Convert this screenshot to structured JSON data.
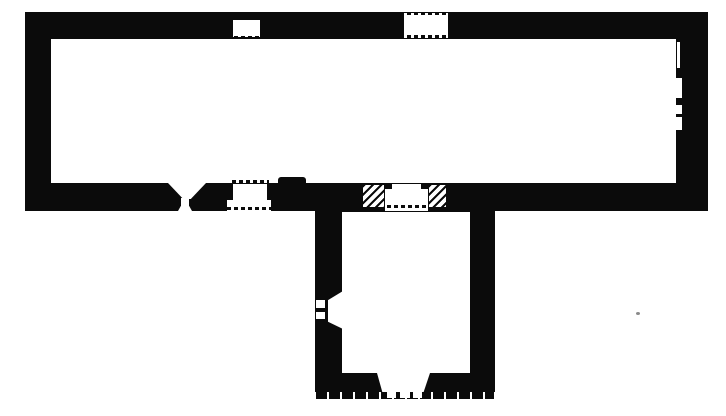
{
  "meta": {
    "kind": "scanned architectural floor plan, black ink on white paper",
    "building": "single long hall with square annex attached below centre-right"
  },
  "colors": {
    "ink": "#0b0b0b",
    "paper": "#ffffff",
    "speck": "#8a8a8a"
  },
  "canvas": {
    "width": 726,
    "height": 416
  },
  "icons": {
    "north_arrow": "upward arrow with crossbar (orientation mark)"
  },
  "elements": [
    {
      "name": "main-hall-walls",
      "type": "wall",
      "x": 25,
      "y": 12,
      "w": 683,
      "h": 199
    },
    {
      "name": "main-hall-floor",
      "type": "floor",
      "x": 51,
      "y": 39,
      "w": 625,
      "h": 144
    },
    {
      "name": "annex-walls",
      "type": "wall",
      "x": 315,
      "y": 211,
      "w": 180,
      "h": 181
    },
    {
      "name": "annex-ground-line",
      "type": "ground",
      "x": 316,
      "y": 392,
      "w": 178,
      "h": 7
    },
    {
      "name": "annex-floor",
      "type": "floor",
      "x": 342,
      "y": 212,
      "w": 128,
      "h": 161
    },
    {
      "name": "north-window-1-dots-outer",
      "type": "dots",
      "x": 233,
      "y": 12,
      "w": 28,
      "h": 3
    },
    {
      "name": "north-window-1-dots-mid",
      "type": "dots",
      "x": 236,
      "y": 16,
      "w": 22,
      "h": 3
    },
    {
      "name": "north-window-1-opening",
      "type": "floor",
      "x": 233,
      "y": 20,
      "w": 27,
      "h": 17
    },
    {
      "name": "north-window-1-dots-inner",
      "type": "dots",
      "x": 234,
      "y": 36,
      "w": 26,
      "h": 3
    },
    {
      "name": "north-window-2-opening",
      "type": "floor",
      "x": 404,
      "y": 13,
      "w": 44,
      "h": 25
    },
    {
      "name": "north-window-2-dots-outer",
      "type": "dots",
      "x": 400,
      "y": 12,
      "w": 52,
      "h": 3
    },
    {
      "name": "north-window-2-dots-inner",
      "type": "dots",
      "x": 400,
      "y": 35,
      "w": 52,
      "h": 3
    },
    {
      "name": "east-wall-niche-1",
      "type": "floor",
      "x": 677,
      "y": 42,
      "w": 3,
      "h": 26
    },
    {
      "name": "east-wall-niche-2",
      "type": "floor",
      "x": 676,
      "y": 78,
      "w": 6,
      "h": 20
    },
    {
      "name": "east-wall-niche-3",
      "type": "floor",
      "x": 676,
      "y": 105,
      "w": 6,
      "h": 9
    },
    {
      "name": "east-wall-niche-4",
      "type": "floor",
      "x": 676,
      "y": 117,
      "w": 6,
      "h": 13
    },
    {
      "name": "font-bowl",
      "type": "shape",
      "x": 168,
      "y": 183,
      "w": 38,
      "h": 16,
      "clip": "polygon(0 0, 100% 0, 60% 100%, 40% 100%)"
    },
    {
      "name": "font-stem",
      "type": "floor",
      "x": 181,
      "y": 198,
      "w": 8,
      "h": 9
    },
    {
      "name": "font-base",
      "type": "shape",
      "x": 178,
      "y": 206,
      "w": 14,
      "h": 5,
      "clip": "polygon(20% 0, 80% 0, 100% 100%, 0 100%)"
    },
    {
      "name": "south-door-dots-inner",
      "type": "dots",
      "x": 232,
      "y": 180,
      "w": 37,
      "h": 3
    },
    {
      "name": "south-door-reveal",
      "type": "floor",
      "x": 233,
      "y": 184,
      "w": 34,
      "h": 16
    },
    {
      "name": "south-door-step",
      "type": "floor",
      "x": 227,
      "y": 200,
      "w": 44,
      "h": 11
    },
    {
      "name": "south-door-dots-outer",
      "type": "dots",
      "x": 227,
      "y": 207,
      "w": 44,
      "h": 3
    },
    {
      "name": "south-wall-pier",
      "type": "wall",
      "x": 278,
      "y": 177,
      "w": 28,
      "h": 7,
      "radius": "3px 3px 0 0"
    },
    {
      "name": "arch-respond-hatch-west",
      "type": "hatch",
      "x": 362,
      "y": 184,
      "w": 23,
      "h": 24
    },
    {
      "name": "arch-respond-hatch-east",
      "type": "hatch",
      "x": 428,
      "y": 184,
      "w": 19,
      "h": 24
    },
    {
      "name": "arch-opening",
      "type": "floor",
      "x": 385,
      "y": 189,
      "w": 43,
      "h": 22
    },
    {
      "name": "arch-opening-rebate",
      "type": "floor",
      "x": 392,
      "y": 184,
      "w": 29,
      "h": 27
    },
    {
      "name": "arch-threshold-dots",
      "type": "dots",
      "x": 387,
      "y": 205,
      "w": 40,
      "h": 3
    },
    {
      "name": "annex-west-window",
      "type": "shape",
      "x": 328,
      "y": 291,
      "w": 15,
      "h": 38,
      "clip": "polygon(100% 0, 100% 100%, 0 81%, 0 24%)"
    },
    {
      "name": "annex-west-window-block-1",
      "type": "floor",
      "x": 316,
      "y": 300,
      "w": 9,
      "h": 8
    },
    {
      "name": "annex-west-window-block-2",
      "type": "floor",
      "x": 316,
      "y": 312,
      "w": 9,
      "h": 7
    },
    {
      "name": "annex-south-portal",
      "type": "shape",
      "x": 377,
      "y": 373,
      "w": 53,
      "h": 19,
      "clip": "polygon(0 0, 100% 0, 88% 100%, 10% 100%)"
    },
    {
      "name": "annex-portal-step-1",
      "type": "floor",
      "x": 387,
      "y": 392,
      "w": 9,
      "h": 6
    },
    {
      "name": "annex-portal-step-2",
      "type": "floor",
      "x": 400,
      "y": 392,
      "w": 10,
      "h": 6
    },
    {
      "name": "annex-portal-step-3",
      "type": "floor",
      "x": 413,
      "y": 392,
      "w": 9,
      "h": 6
    },
    {
      "name": "print-speck",
      "type": "speck",
      "x": 636,
      "y": 312,
      "w": 4,
      "h": 3
    }
  ]
}
